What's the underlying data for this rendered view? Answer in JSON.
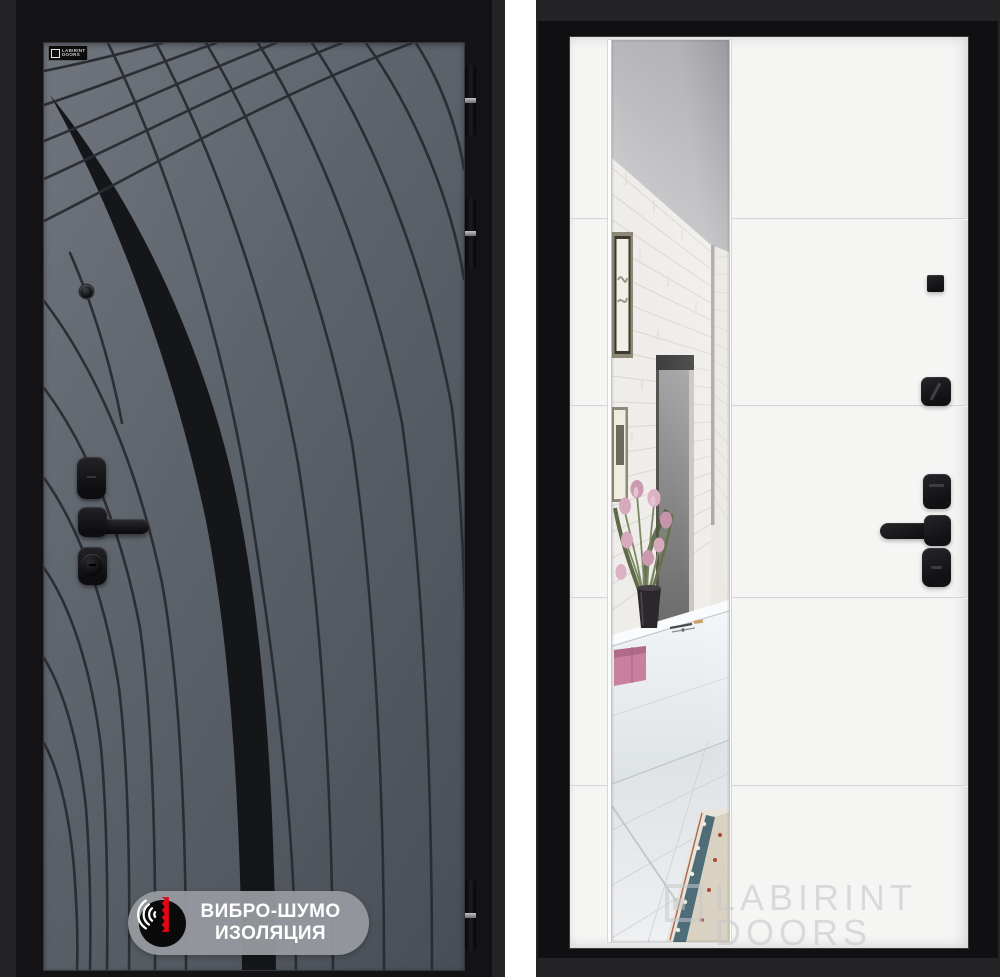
{
  "left_photo": {
    "description": "entrance door exterior side, graphite panel with engraved flow lines",
    "brand_plate": {
      "line1": "LABIRINT",
      "line2": "DOORS"
    },
    "insulation_badge": {
      "line1": "ВИБРО-ШУМО",
      "line2": "ИЗОЛЯЦИЯ",
      "icon": "sound-waves-icon",
      "pill_color": "#969a9f",
      "icon_bg": "#0a0a0b",
      "accent_red": "#e30613"
    },
    "colors": {
      "panel": "#5d636b",
      "pattern": "#282c31",
      "frame": "#131316",
      "background": "#242427"
    }
  },
  "right_photo": {
    "description": "door interior side, white panel with full-height mirror reflecting hallway with tulips",
    "watermark": {
      "line1": "LABIRINT",
      "line2": "DOORS",
      "color": "#c6c6c8"
    },
    "colors": {
      "leaf": "#f5f5f4",
      "frame": "#101013",
      "hardware": "#1b1b1e",
      "background": "#242427"
    }
  }
}
